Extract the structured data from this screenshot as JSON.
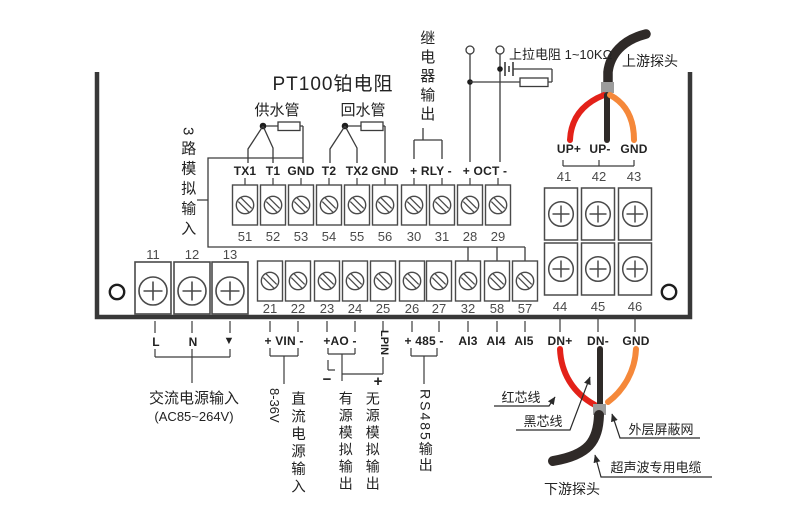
{
  "colors": {
    "wire_red": "#e32119",
    "wire_black": "#2f2a28",
    "wire_orange": "#f5883a",
    "cable_band": "#9c9c9c",
    "line": "#3c3c3c"
  },
  "header": {
    "pt100_title": "PT100铂电阻",
    "supply_pipe": "供水管",
    "return_pipe": "回水管",
    "relay_output": "继电器输出",
    "analog_input": "3路模拟输入",
    "pullup_resistor": "上拉电阻 1~10KΩ",
    "upstream_probe": "上游探头"
  },
  "upper_strip": {
    "labels": [
      "TX1",
      "T1",
      "GND",
      "T2",
      "TX2",
      "GND",
      "+ RLY -",
      "+ OCT -"
    ],
    "numbers": [
      "51",
      "52",
      "53",
      "54",
      "55",
      "56",
      "30",
      "31",
      "28",
      "29"
    ]
  },
  "lower_strip": {
    "numbers": [
      "21",
      "22",
      "23",
      "24",
      "25",
      "26",
      "27",
      "32",
      "58",
      "57"
    ],
    "io_labels": {
      "vin": "+ VIN -",
      "ao": "+AO -",
      "lpin": "LPIN",
      "rs485": "+ 485 -",
      "ai3": "AI3",
      "ai4": "AI4",
      "ai5": "AI5"
    }
  },
  "power_block": {
    "numbers": [
      "11",
      "12",
      "13"
    ],
    "labels": [
      "L",
      "N",
      "▼"
    ]
  },
  "probe_block": {
    "up_numbers": [
      "41",
      "42",
      "43"
    ],
    "up_labels": [
      "UP+",
      "UP-",
      "GND"
    ],
    "dn_numbers": [
      "44",
      "45",
      "46"
    ],
    "dn_labels": [
      "DN+",
      "DN-",
      "GND"
    ]
  },
  "annotations": {
    "ac_input": "交流电源输入",
    "ac_range": "(AC85~264V)",
    "dc_range": "8-36V",
    "dc_input": "直流电源输入",
    "active_analog_out": "有源模拟输出",
    "passive_analog_out": "无源模拟输出",
    "minus": "−",
    "plus": "+",
    "rs485_output": "RS485输出",
    "red_core": "红芯线",
    "black_core": "黑芯线",
    "outer_shield": "外层屏蔽网",
    "ultrasonic_cable": "超声波专用电缆",
    "downstream_probe": "下游探头"
  }
}
